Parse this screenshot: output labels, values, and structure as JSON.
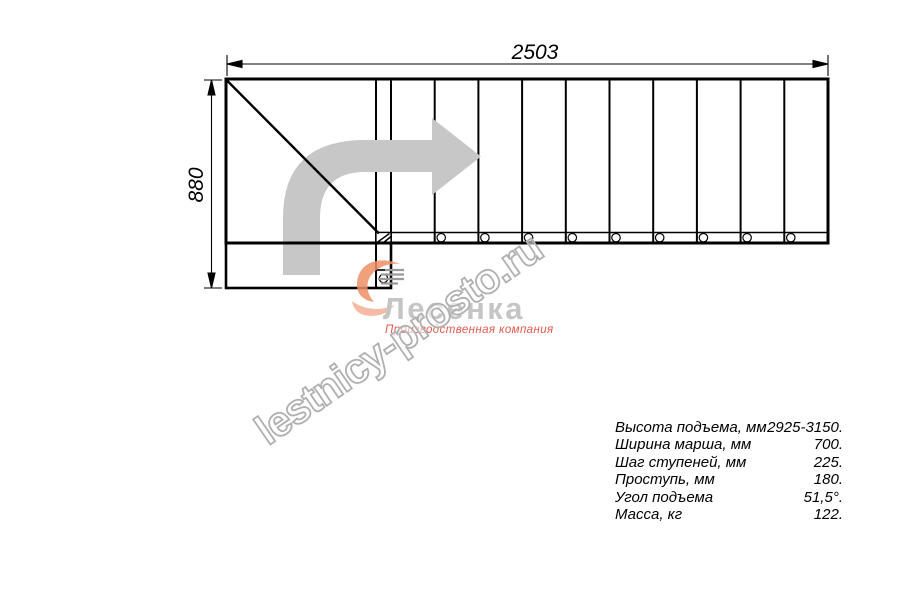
{
  "page": {
    "background": "#ffffff"
  },
  "dimension_labels": {
    "total_length_mm": "2503",
    "total_width_mm": "880"
  },
  "specifications": {
    "rows": [
      {
        "label": "Высота подъема, мм",
        "value": "2925-3150."
      },
      {
        "label": "Ширина марша, мм",
        "value": "700."
      },
      {
        "label": "Шаг ступеней, мм",
        "value": "225."
      },
      {
        "label": "Проступь, мм",
        "value": "180."
      },
      {
        "label": "Угол подъема",
        "value": "51,5°."
      },
      {
        "label": "Масса, кг",
        "value": "122."
      }
    ]
  },
  "watermark": {
    "text": "lestnicy-prosto.ru",
    "color": "#b0b0b0"
  },
  "logo": {
    "company": "Лесенка",
    "tagline": "Производственная компания",
    "text_color": "#c5c5c5",
    "accent_color": "#e2584c"
  },
  "drawing": {
    "line_color": "#000000",
    "direction_arrow_color": "#c7c7c7"
  }
}
